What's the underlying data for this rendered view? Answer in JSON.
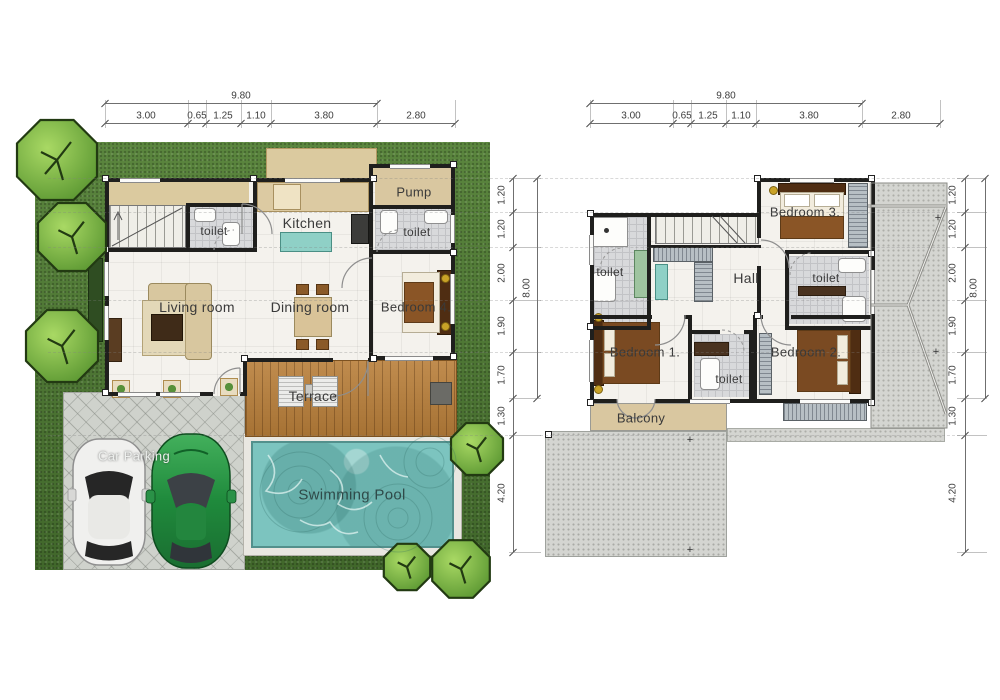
{
  "first_floor": {
    "labels": {
      "pump": "Pump",
      "toilet_top": "toilet",
      "kitchen": "Kitchen",
      "toilet_right": "toilet",
      "living": "Living room",
      "dining": "Dining room",
      "bedroom4": "Bedroom 4.",
      "terrace": "Terrace",
      "pool": "Swimming Pool",
      "parking": "Car Parking"
    }
  },
  "second_floor": {
    "labels": {
      "bedroom3": "Bedroom 3.",
      "toilet_left": "toilet",
      "hall": "Hall",
      "toilet_right": "toilet",
      "bedroom1": "Bedroom 1.",
      "toilet_mid": "toilet",
      "bedroom2": "Bedroom 2.",
      "balcony": "Balcony"
    }
  },
  "dimensions": {
    "width_total": "9.80",
    "width_segments": [
      "3.00",
      "0.65",
      "1.25",
      "1.10",
      "3.80",
      "2.80"
    ],
    "height_total": "8.00",
    "height_segments": [
      "1.20",
      "1.20",
      "2.00",
      "1.90",
      "1.70",
      "1.30",
      "4.20"
    ]
  },
  "colors": {
    "grass": "#4e7a35",
    "pool": "#7cc4bf",
    "wood": "#b97f3a",
    "concrete": "#cfd2cc",
    "patio": "#d4d5d1",
    "roof": "#d4d5d1",
    "wall": "#1f1f1d",
    "floor": "#f4f2ed",
    "beige": "#d9c7a0",
    "tile": "#d8d9db",
    "closet": "#b7bfc4",
    "bed": "#8a5526",
    "frame": "#4f2d12",
    "ink": "#3a3a3a"
  }
}
